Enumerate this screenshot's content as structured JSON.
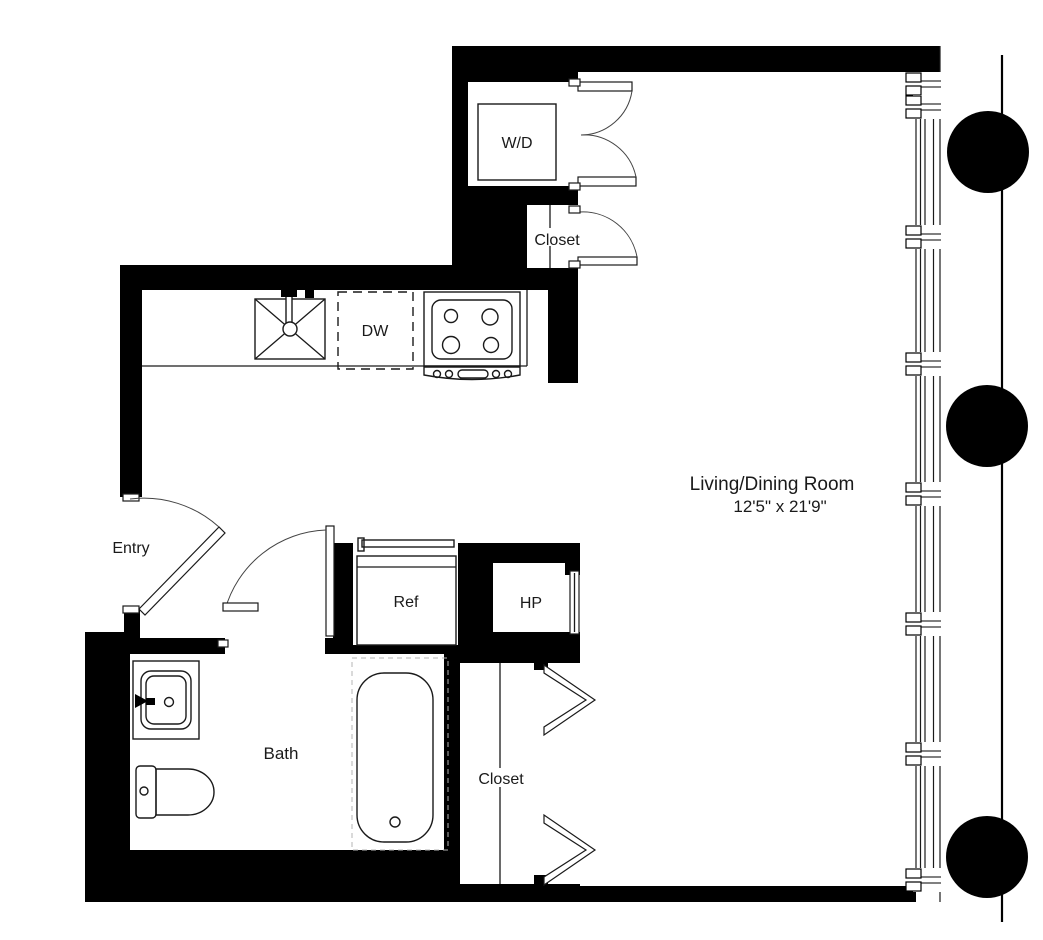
{
  "plan": {
    "rooms": {
      "living_dining": {
        "label": "Living/Dining Room",
        "dimensions": "12'5\" x 21'9\""
      },
      "entry": {
        "label": "Entry"
      },
      "bath": {
        "label": "Bath"
      },
      "upper_closet": {
        "label": "Closet"
      },
      "lower_closet": {
        "label": "Closet"
      }
    },
    "fixtures": {
      "washer_dryer": {
        "label": "W/D"
      },
      "dishwasher": {
        "label": "DW"
      },
      "refrigerator": {
        "label": "Ref"
      },
      "heat_pump": {
        "label": "HP"
      }
    },
    "colors": {
      "wall": "#000000",
      "line": "#1a1a1a",
      "floor": "#ffffff",
      "tub_outline": "#b5b5b5"
    }
  }
}
